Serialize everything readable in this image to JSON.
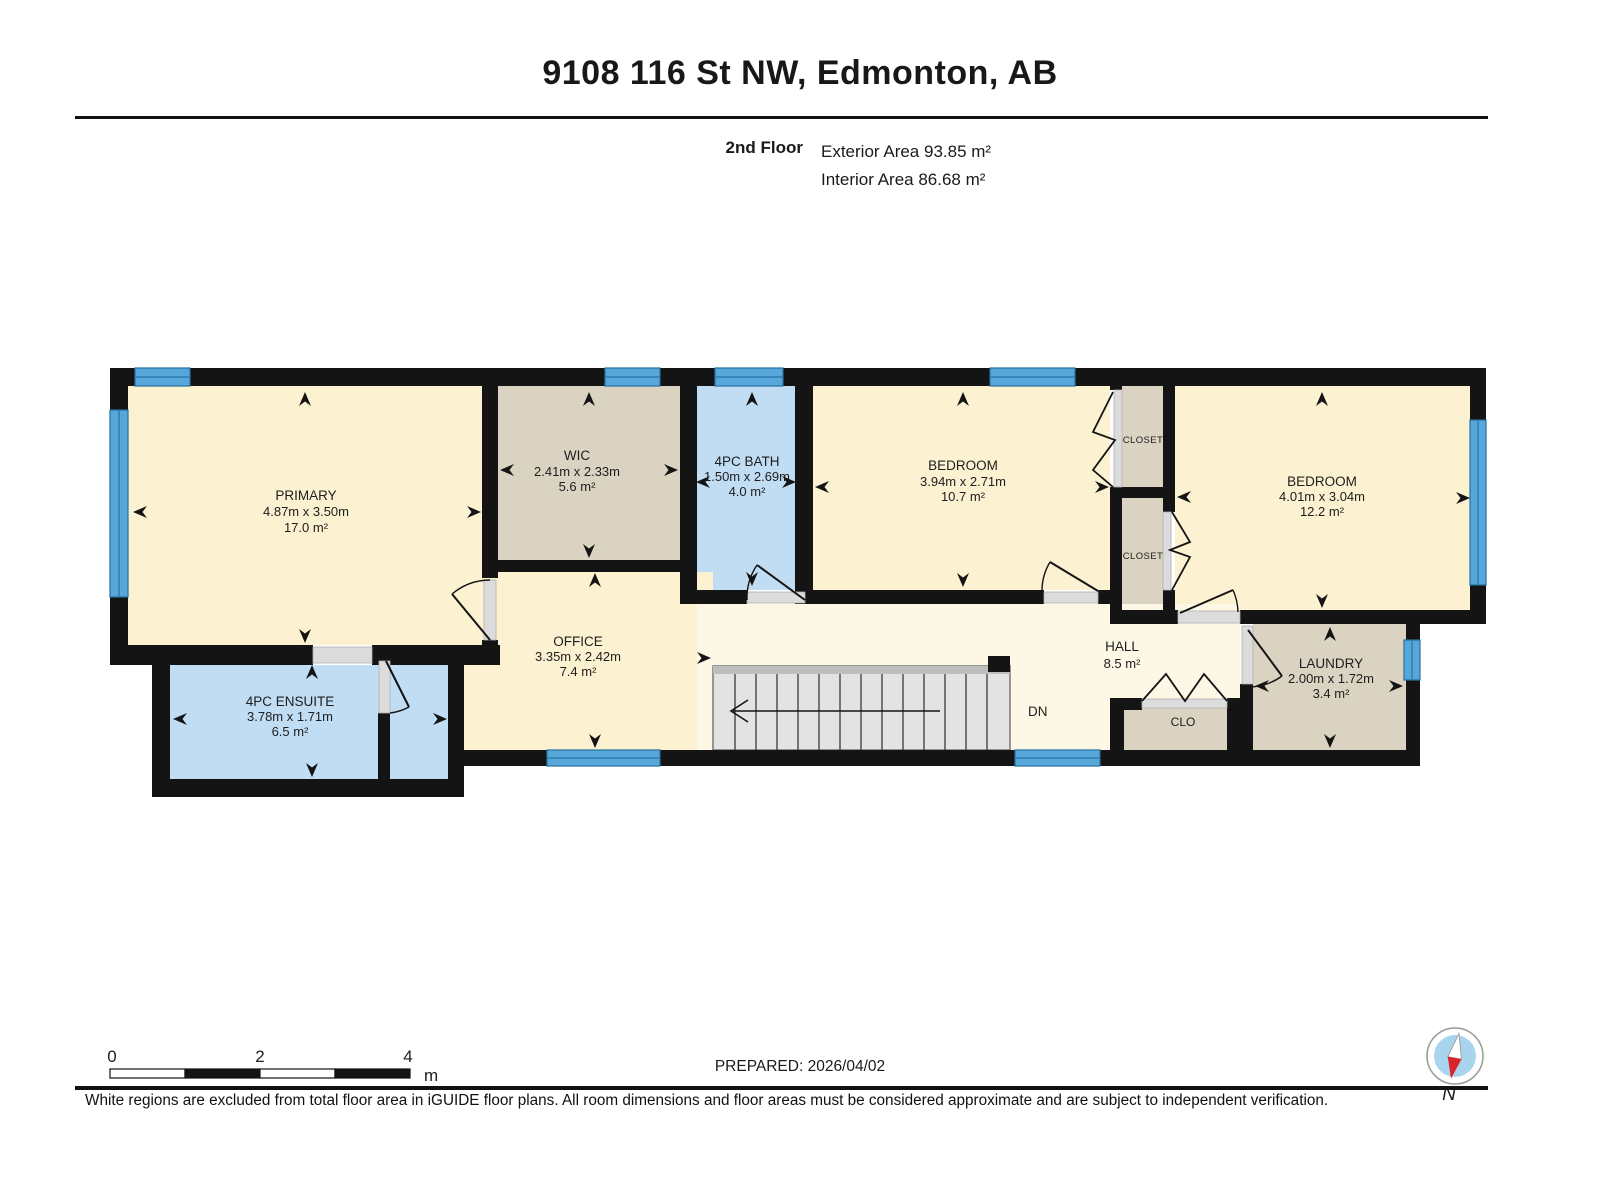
{
  "header": {
    "title": "9108 116 St NW, Edmonton, AB",
    "floor_label": "2nd Floor",
    "exterior_area": "Exterior Area 93.85 m²",
    "interior_area": "Interior Area 86.68 m²"
  },
  "rooms": {
    "primary": {
      "name": "PRIMARY",
      "dims": "4.87m x 3.50m",
      "area": "17.0 m²"
    },
    "wic": {
      "name": "WIC",
      "dims": "2.41m x 2.33m",
      "area": "5.6 m²"
    },
    "bath": {
      "name": "4PC BATH",
      "dims": "1.50m x 2.69m",
      "area": "4.0 m²"
    },
    "bedroom_middle": {
      "name": "BEDROOM",
      "dims": "3.94m x 2.71m",
      "area": "10.7 m²"
    },
    "bedroom_right": {
      "name": "BEDROOM",
      "dims": "4.01m x 3.04m",
      "area": "12.2 m²"
    },
    "ensuite": {
      "name": "4PC ENSUITE",
      "dims": "3.78m x 1.71m",
      "area": "6.5 m²"
    },
    "office": {
      "name": "OFFICE",
      "dims": "3.35m x 2.42m",
      "area": "7.4 m²"
    },
    "hall": {
      "name": "HALL",
      "area": "8.5 m²"
    },
    "laundry": {
      "name": "LAUNDRY",
      "dims": "2.00m x 1.72m",
      "area": "3.4 m²"
    },
    "closet_top": {
      "name": "CLOSET"
    },
    "closet_bottom": {
      "name": "CLOSET"
    },
    "clo": {
      "name": "CLO"
    }
  },
  "stairs": {
    "label": "DN"
  },
  "scale_bar": {
    "ticks": [
      "0",
      "2",
      "4"
    ],
    "unit": "m"
  },
  "compass": {
    "label": "N"
  },
  "footer": {
    "prepared": "PREPARED: 2026/04/02",
    "disclaimer": "White regions are excluded from total floor area in iGUIDE floor plans. All room dimensions and floor areas must be considered approximate and are subject to independent verification."
  },
  "colors": {
    "wall": "#141414",
    "room": "#fcf1d1",
    "hall": "#fdf8e5",
    "wet": "#c0ddf4",
    "closet": "#dbd3c1",
    "window": "#58a7da",
    "threshold": "#dcdcdc",
    "stair": "#e3e3e3",
    "compass_red": "#d8252c",
    "compass_blue": "#a9d4ee"
  }
}
